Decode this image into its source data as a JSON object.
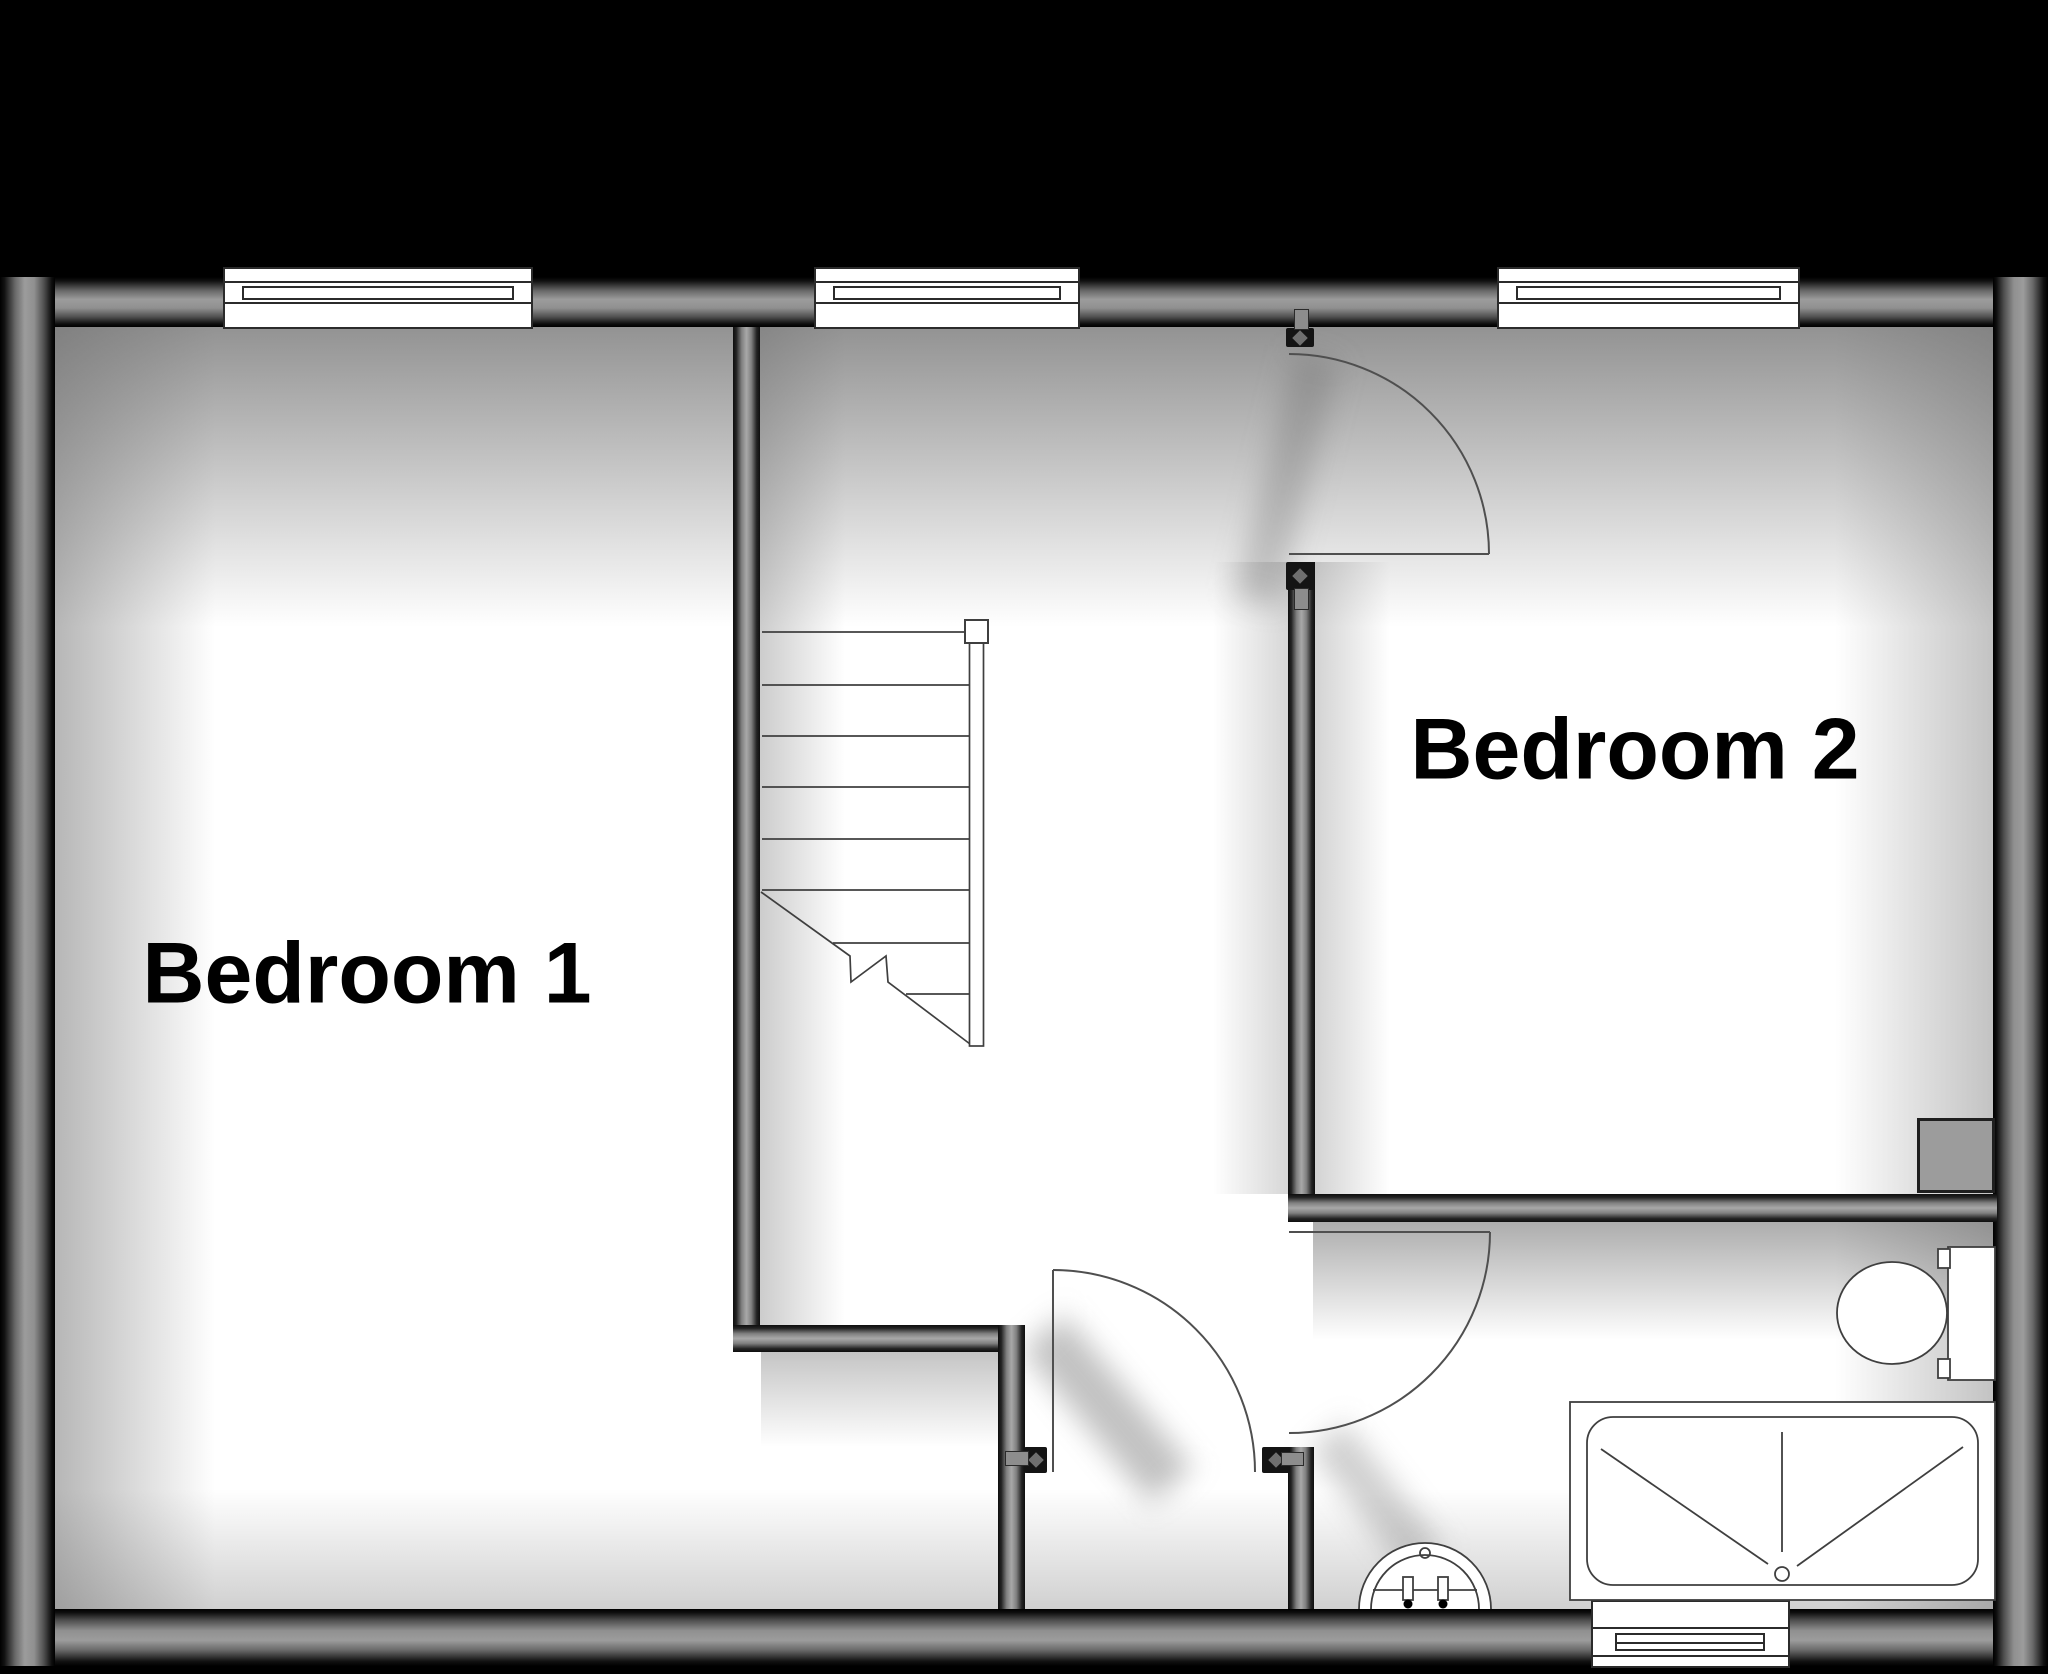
{
  "plan_type": "floor-plan",
  "palette": {
    "background": "#000000",
    "wall_core": "#9a9a9a",
    "floor": "#ffffff",
    "fixture_line": "#3f3f3f",
    "label_color": "#000000"
  },
  "rooms": [
    {
      "id": "bedroom-1",
      "label": "Bedroom 1"
    },
    {
      "id": "bedroom-2",
      "label": "Bedroom 2"
    }
  ],
  "doors": {
    "count": 3,
    "names": [
      "bedroom-2-door",
      "landing-door",
      "bathroom-door"
    ]
  },
  "windows": {
    "count": 4,
    "positions": [
      "top-left",
      "top-middle",
      "top-right",
      "bottom-bathroom"
    ]
  },
  "stairs": {
    "visible_treads": 8,
    "has_break_line": true,
    "has_newel_post": true
  },
  "fixtures": [
    "staircase",
    "bath",
    "toilet",
    "pedestal-sink",
    "chimney-breast"
  ]
}
